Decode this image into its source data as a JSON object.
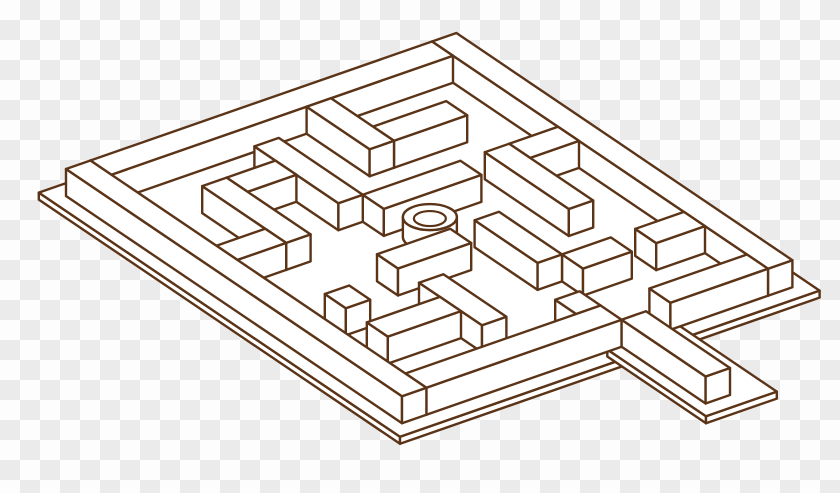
{
  "canvas": {
    "width": 840,
    "height": 493
  },
  "background": {
    "type": "transparency-checkerboard",
    "checker_size_px": 20,
    "checker_light": "#fdfdfd",
    "checker_dark": "#ebebeb"
  },
  "illustration": {
    "subject": "isometric-maze-clipart",
    "line_color": "#5b3418",
    "face_color": "#ffffff",
    "stroke_width": 2.4,
    "wall_height_px": 27,
    "plate_thickness_px": 7,
    "projection": {
      "origin_x": 66,
      "origin_y": 196,
      "x_axis_dx": 21,
      "x_axis_dy": 14.2,
      "depth_axis_dx": 24.4,
      "depth_axis_dy": -8.5,
      "grid_units": 16
    },
    "plates": [
      {
        "name": "main-base-plate",
        "x0": -0.6,
        "y0": -0.6,
        "x1": 16.6,
        "y1": 16.6
      },
      {
        "name": "exit-chute-plate",
        "x0": 15.9,
        "y0": 4.6,
        "x1": 20.6,
        "y1": 7.5
      }
    ],
    "blocks": [
      {
        "kind": "wall",
        "name": "outer-wall-north",
        "x0": 0,
        "y0": 0,
        "x1": 16,
        "y1": 1
      },
      {
        "kind": "wall",
        "name": "outer-wall-west",
        "x0": 0,
        "y0": 1,
        "x1": 1,
        "y1": 15
      },
      {
        "kind": "wall",
        "name": "inner-stub-top-center",
        "x0": 6,
        "y0": 1,
        "x1": 7,
        "y1": 3
      },
      {
        "kind": "wall",
        "name": "inner-wall-left-a",
        "x0": 3,
        "y0": 3,
        "x1": 4,
        "y1": 6
      },
      {
        "kind": "wall",
        "name": "inner-wall-left-b",
        "x0": 1,
        "y0": 6,
        "x1": 4,
        "y1": 7
      },
      {
        "kind": "wall",
        "name": "inner-wall-top-run",
        "x0": 6,
        "y0": 3,
        "x1": 10,
        "y1": 4
      },
      {
        "kind": "wall",
        "name": "inner-stub-top-right",
        "x0": 12,
        "y0": 1,
        "x1": 13,
        "y1": 3
      },
      {
        "kind": "wall",
        "name": "inner-wall-center-west",
        "x0": 6,
        "y0": 5,
        "x1": 7,
        "y1": 9
      },
      {
        "kind": "wall",
        "name": "inner-wall-mid-left",
        "x0": 2,
        "y0": 9,
        "x1": 6,
        "y1": 10
      },
      {
        "kind": "wall",
        "name": "inner-stub-lower-left",
        "x0": 3,
        "y0": 10,
        "x1": 4,
        "y1": 12
      },
      {
        "kind": "wall",
        "name": "inner-wall-right-a",
        "x0": 12,
        "y0": 4,
        "x1": 13,
        "y1": 6
      },
      {
        "kind": "wall",
        "name": "inner-wall-gap-feed",
        "x0": 9,
        "y0": 6,
        "x1": 12,
        "y1": 7
      },
      {
        "kind": "wall",
        "name": "inner-wall-bottom-left",
        "x0": 3,
        "y0": 12,
        "x1": 7,
        "y1": 13
      },
      {
        "kind": "cylinder",
        "name": "goal-cylinder",
        "x": 7.8,
        "y": 7.8
      },
      {
        "kind": "wall",
        "name": "outer-wall-east-upper",
        "x0": 15,
        "y0": 1,
        "x1": 16,
        "y1": 5
      },
      {
        "kind": "wall",
        "name": "inner-wall-center-east",
        "x0": 9,
        "y0": 8,
        "x1": 10,
        "y1": 11
      },
      {
        "kind": "wall",
        "name": "inner-stub-bottom",
        "x0": 6,
        "y0": 13,
        "x1": 7,
        "y1": 15
      },
      {
        "kind": "wall",
        "name": "step-block-gap",
        "x0": 14,
        "y0": 7,
        "x1": 15,
        "y1": 8
      },
      {
        "kind": "wall",
        "name": "inner-wall-lower-right",
        "x0": 11,
        "y0": 10,
        "x1": 14,
        "y1": 11
      },
      {
        "kind": "wall",
        "name": "free-block-bottom",
        "x0": 10,
        "y0": 13,
        "x1": 11,
        "y1": 14
      },
      {
        "kind": "wall",
        "name": "outer-wall-east-lower",
        "x0": 15,
        "y0": 7,
        "x1": 16,
        "y1": 15
      },
      {
        "kind": "wall",
        "name": "exit-chute-wall",
        "x0": 16,
        "y0": 6,
        "x1": 20,
        "y1": 7
      },
      {
        "kind": "wall",
        "name": "inner-wall-right-b",
        "x0": 12,
        "y0": 11,
        "x1": 13,
        "y1": 14
      },
      {
        "kind": "wall",
        "name": "outer-wall-south",
        "x0": 0,
        "y0": 15,
        "x1": 16,
        "y1": 16
      }
    ],
    "cylinder": {
      "radius_x": 27,
      "radius_y": 13,
      "inner_radius_x": 16,
      "inner_radius_y": 7.5,
      "height_px": 20
    }
  }
}
